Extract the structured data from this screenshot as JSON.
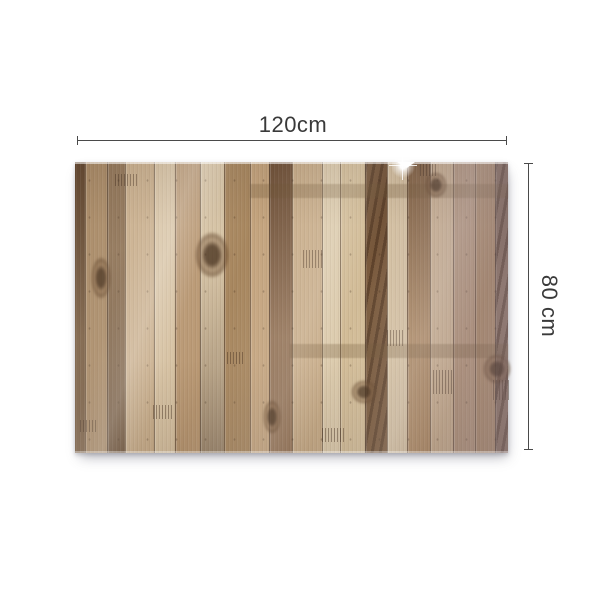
{
  "annotations": {
    "width_label": "120cm",
    "height_label": "80 cm",
    "line_color": "#4a4a4a",
    "label_color": "#3a3a3a"
  },
  "background_color": "#ffffff",
  "panel": {
    "description": "glossy wooden plank panel, vertical planks",
    "planks": [
      {
        "w": 10,
        "c": "#7d6247",
        "v": "darktop"
      },
      {
        "w": 22,
        "c": "#a98a66",
        "v": ""
      },
      {
        "w": 18,
        "c": "#8f7355",
        "v": "darkbottom"
      },
      {
        "w": 29,
        "c": "#c8ad8a",
        "v": ""
      },
      {
        "w": 21,
        "c": "#d6c1a1",
        "v": ""
      },
      {
        "w": 25,
        "c": "#b99873",
        "v": ""
      },
      {
        "w": 24,
        "c": "#d8c5a6",
        "v": "darkbottom"
      },
      {
        "w": 26,
        "c": "#a8875f",
        "v": ""
      },
      {
        "w": 19,
        "c": "#c4a47e",
        "v": ""
      },
      {
        "w": 23,
        "c": "#96765a",
        "v": "darktop"
      },
      {
        "w": 30,
        "c": "#c9ae8b",
        "v": ""
      },
      {
        "w": 18,
        "c": "#dccbad",
        "v": ""
      },
      {
        "w": 25,
        "c": "#d2bc97",
        "v": ""
      },
      {
        "w": 22,
        "c": "#7c5c3e",
        "v": "zebra"
      },
      {
        "w": 20,
        "c": "#d7c3a3",
        "v": ""
      },
      {
        "w": 23,
        "c": "#b08c64",
        "v": "darktop"
      },
      {
        "w": 23,
        "c": "#cbb190",
        "v": ""
      },
      {
        "w": 22,
        "c": "#b4967a",
        "v": ""
      },
      {
        "w": 20,
        "c": "#ab8a68",
        "v": ""
      },
      {
        "w": 13,
        "c": "#8d7462",
        "v": "zebra"
      }
    ],
    "knots": [
      {
        "x": 120,
        "y": 70,
        "w": 34,
        "h": 46
      },
      {
        "x": 16,
        "y": 95,
        "w": 20,
        "h": 42
      },
      {
        "x": 276,
        "y": 218,
        "w": 26,
        "h": 24
      },
      {
        "x": 408,
        "y": 192,
        "w": 28,
        "h": 30
      },
      {
        "x": 350,
        "y": 10,
        "w": 22,
        "h": 26
      },
      {
        "x": 188,
        "y": 238,
        "w": 18,
        "h": 34
      }
    ],
    "bands": [
      {
        "x": 175,
        "y": 22,
        "w": 258,
        "h": 14
      },
      {
        "x": 215,
        "y": 182,
        "w": 218,
        "h": 14
      }
    ],
    "combs": [
      {
        "x": 40,
        "y": 12,
        "w": 22,
        "h": 12
      },
      {
        "x": 228,
        "y": 88,
        "w": 20,
        "h": 18
      },
      {
        "x": 312,
        "y": 168,
        "w": 16,
        "h": 16
      },
      {
        "x": 358,
        "y": 208,
        "w": 20,
        "h": 24
      },
      {
        "x": 418,
        "y": 218,
        "w": 18,
        "h": 20
      },
      {
        "x": 78,
        "y": 243,
        "w": 20,
        "h": 14
      },
      {
        "x": 152,
        "y": 190,
        "w": 18,
        "h": 12
      },
      {
        "x": 247,
        "y": 266,
        "w": 22,
        "h": 14
      },
      {
        "x": 345,
        "y": 2,
        "w": 16,
        "h": 12
      },
      {
        "x": 5,
        "y": 258,
        "w": 16,
        "h": 12
      }
    ]
  }
}
